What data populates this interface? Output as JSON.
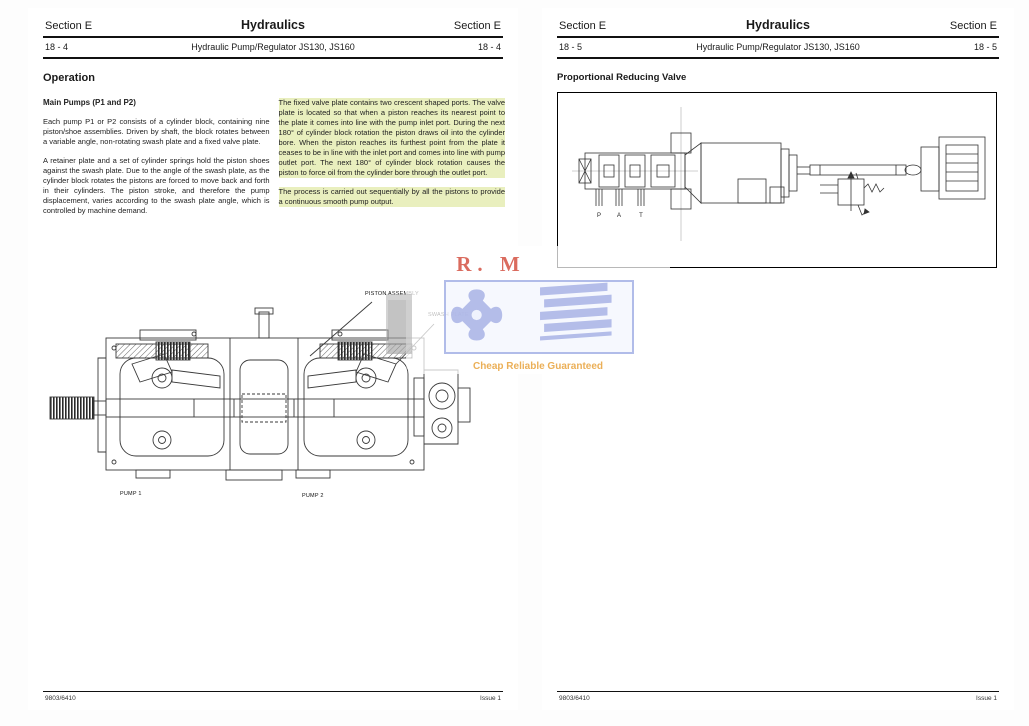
{
  "colors": {
    "page_bg": "#ffffff",
    "text": "#1a1a1a",
    "highlight": "#e9efbe",
    "rule": "#111111",
    "diagram_stroke": "#3a3a3a",
    "watermark_blue": "#a9b3e6",
    "watermark_red": "#cc3a28",
    "watermark_orange": "#e39a33"
  },
  "watermark": {
    "title": "R. M",
    "tagline": "Cheap Reliable Guaranteed"
  },
  "left_page": {
    "header": {
      "section_left": "Section E",
      "title": "Hydraulics",
      "section_right": "Section E",
      "page_number_left": "18 - 4",
      "subtitle": "Hydraulic Pump/Regulator JS130, JS160",
      "page_number_right": "18 - 4"
    },
    "heading": "Operation",
    "column1": {
      "subheading": "Main Pumps (P1 and P2)",
      "para1": "Each pump P1 or P2 consists of a cylinder block, containing nine piston/shoe assemblies. Driven by shaft, the block rotates between a variable angle, non-rotating swash plate and a fixed valve plate.",
      "para2": "A retainer plate and a set of cylinder springs hold the piston shoes against the swash plate. Due to the angle of the swash plate, as the cylinder block rotates the pistons are forced to move back and forth in their cylinders. The piston stroke, and therefore the pump displacement, varies according to the swash plate angle, which is controlled by machine demand."
    },
    "column2": {
      "para1": "The fixed valve plate contains two crescent shaped ports. The valve plate is located so that when a piston reaches its nearest point to the plate it comes into line with the pump inlet port. During the next 180° of cylinder block rotation the piston draws oil into the cylinder bore. When the piston reaches its furthest point from the plate it ceases to be in line with the inlet port and comes into line with pump outlet port. The next 180° of cylinder block rotation causes the piston to force oil from the cylinder bore through the outlet port.",
      "para2": "The process is carried out sequentially by all the pistons to provide a continuous smooth pump output."
    },
    "diagram": {
      "label_piston_assembly": "PISTON ASSEMBLY",
      "label_swash_plate": "SWASH PLATE",
      "label_pump_1": "PUMP 1",
      "label_pump_2": "PUMP 2"
    },
    "footer": {
      "publication_number": "9803/6410",
      "issue": "Issue 1"
    }
  },
  "right_page": {
    "header": {
      "section_left": "Section E",
      "title": "Hydraulics",
      "section_right": "Section E",
      "page_number_left": "18 - 5",
      "subtitle": "Hydraulic Pump/Regulator JS130, JS160",
      "page_number_right": "18 - 5"
    },
    "heading": "Proportional Reducing Valve",
    "diagram": {
      "port_labels": [
        "P",
        "A",
        "T"
      ]
    },
    "footer": {
      "publication_number": "9803/6410",
      "issue": "Issue 1"
    }
  }
}
